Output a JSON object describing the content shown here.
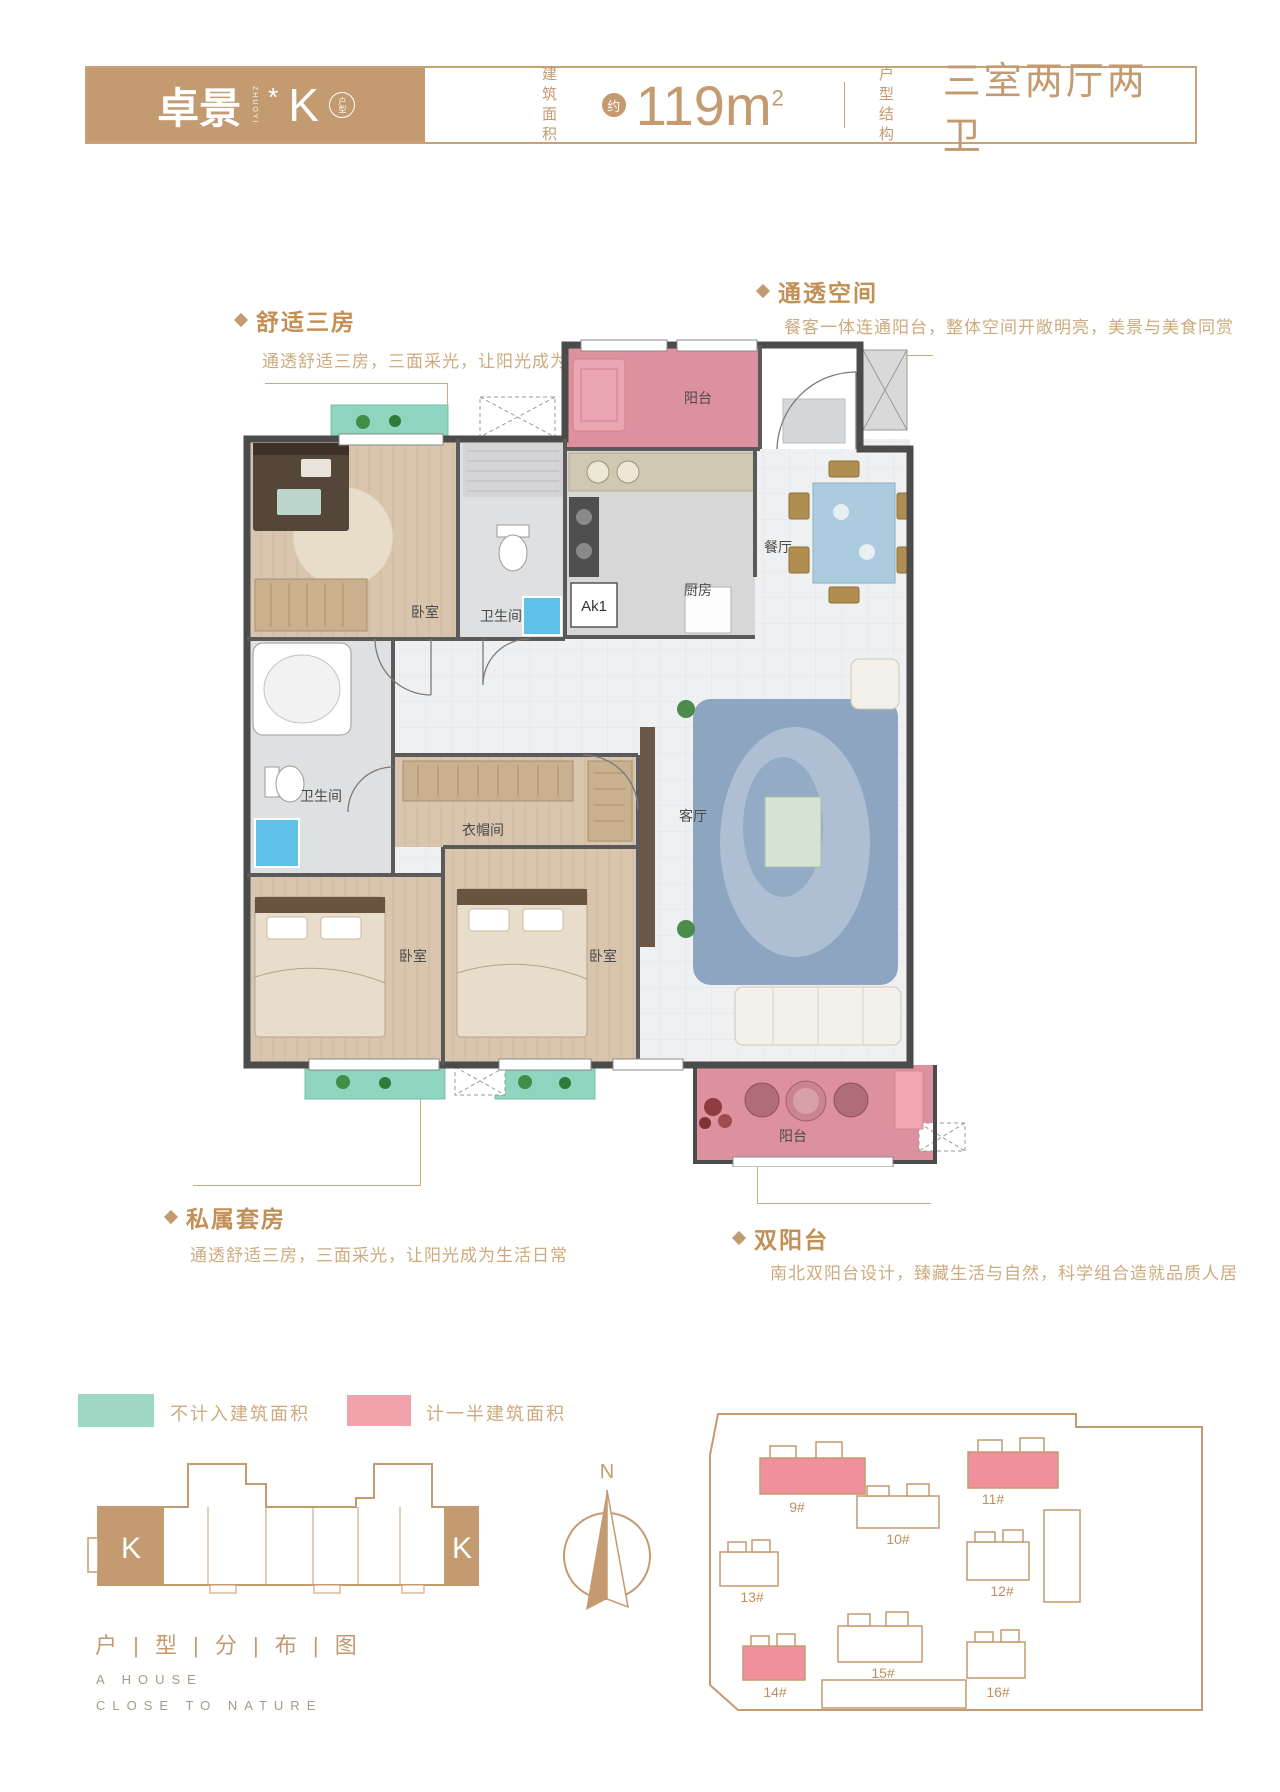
{
  "header": {
    "brand": "卓景",
    "brand_vertical": "ZHUOYI",
    "star": "*",
    "unit_letter": "K",
    "unit_badge": "户型",
    "area_label_top": "建 筑",
    "area_label_bottom": "面 积",
    "area_approx": "约",
    "area_value": "119m",
    "area_sup": "2",
    "struct_label_top": "户 型",
    "struct_label_bottom": "结 构",
    "struct_value": "三室两厅两卫"
  },
  "annotations": {
    "comfort": {
      "title": "舒适三房",
      "desc": "通透舒适三房，三面采光，让阳光成为生活日常"
    },
    "open_space": {
      "title": "通透空间",
      "desc": "餐客一体连通阳台，整体空间开敞明亮，美景与美食同赏"
    },
    "suite": {
      "title": "私属套房",
      "desc": "通透舒适三房，三面采光，让阳光成为生活日常"
    },
    "double_balcony": {
      "title": "双阳台",
      "desc": "南北双阳台设计，臻藏生活与自然，科学组合造就品质人居"
    }
  },
  "floorplan": {
    "rooms": {
      "balcony_north": "阳台",
      "kitchen": "厨房",
      "dining": "餐厅",
      "bedroom_top": "卧室",
      "bath_top": "卫生间",
      "bath_left": "卫生间",
      "closet": "衣帽间",
      "bedroom_left": "卧室",
      "bedroom_mid": "卧室",
      "living": "客厅",
      "balcony_south": "阳台",
      "ac_label": "Ak1"
    }
  },
  "legend": {
    "not_counted": "不计入建筑面积",
    "half_counted": "计一半建筑面积"
  },
  "distribution": {
    "title": "户 | 型 | 分 | 布 | 图",
    "unit_left": "K",
    "unit_right": "K",
    "tagline_line1": "A HOUSE",
    "tagline_line2": "CLOSE TO NATURE"
  },
  "compass": {
    "north": "N"
  },
  "siteplan": {
    "buildings": [
      {
        "id": "9#",
        "highlight": true
      },
      {
        "id": "10#",
        "highlight": false
      },
      {
        "id": "11#",
        "highlight": true
      },
      {
        "id": "12#",
        "highlight": false
      },
      {
        "id": "13#",
        "highlight": false
      },
      {
        "id": "14#",
        "highlight": true
      },
      {
        "id": "15#",
        "highlight": false
      },
      {
        "id": "16#",
        "highlight": false
      }
    ]
  },
  "colors": {
    "accent": "#c49a70",
    "accent_light": "#cdab7e",
    "wall": "#4b4b4b",
    "balcony_pink": "#dd919e",
    "legend_teal": "#9ed8c4",
    "legend_pink": "#f2a2ac",
    "siteplan_pink": "#f0909c",
    "wood": "#d9c5ae",
    "tile": "#eef0f2"
  }
}
